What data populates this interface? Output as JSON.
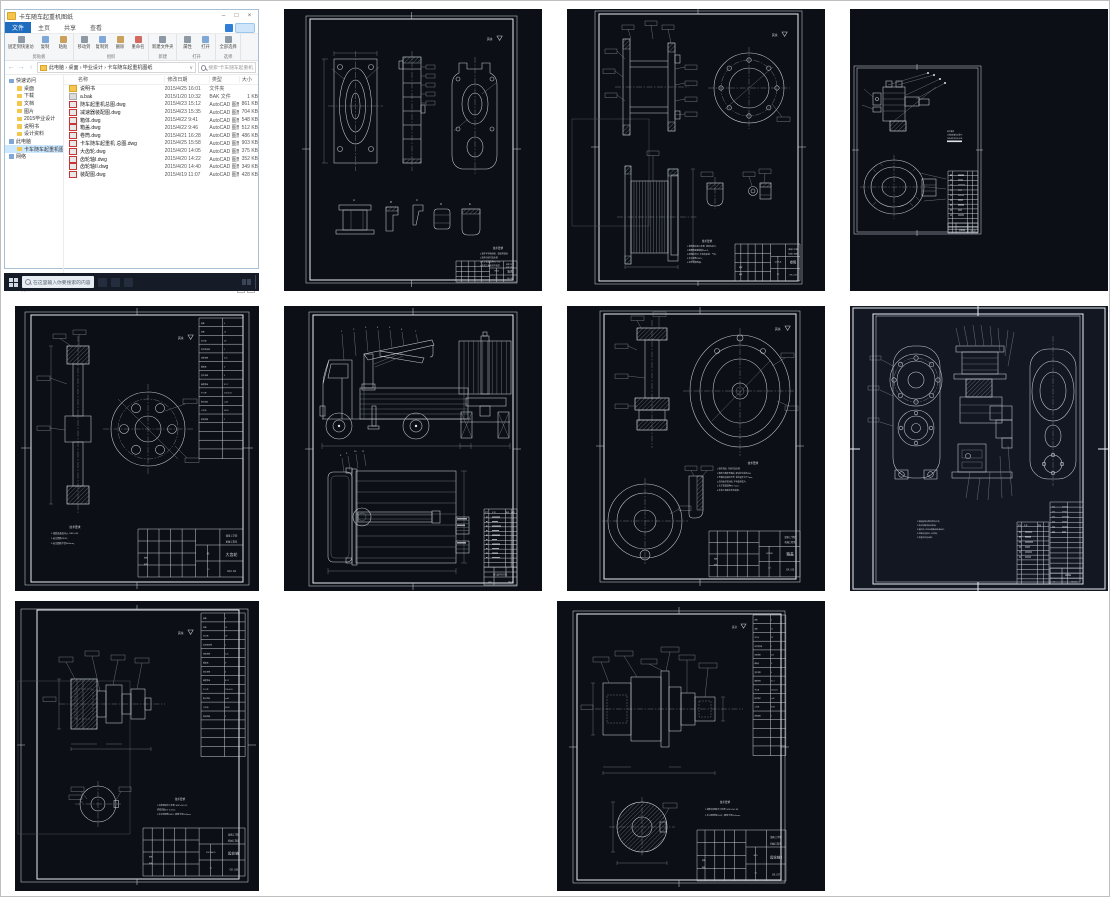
{
  "explorer": {
    "title": "卡车随车起重机图纸",
    "window_controls": {
      "minimize": "–",
      "maximize": "□",
      "close": "×"
    },
    "tabs": {
      "file": "文件",
      "home": "主页",
      "share": "共享",
      "view": "查看"
    },
    "ribbon": {
      "g1": {
        "label": "剪贴板",
        "items": [
          "固定到快速访问",
          "复制",
          "粘贴"
        ]
      },
      "g2": {
        "label": "组织",
        "items": [
          "移动到",
          "复制到",
          "删除",
          "重命名"
        ]
      },
      "g3": {
        "label": "新建",
        "items": [
          "新建文件夹"
        ]
      },
      "g4": {
        "label": "打开",
        "items": [
          "属性",
          "打开"
        ]
      },
      "g5": {
        "label": "选择",
        "items": [
          "全部选择"
        ]
      }
    },
    "nav_arrows": {
      "back": "←",
      "forward": "→",
      "up": "↑"
    },
    "address": "此电脑 › 桌面 › 毕业设计 › 卡车随车起重机图纸",
    "address_chevron": "∨",
    "search_text": "搜索\"卡车随车起重机图纸\"",
    "columns": {
      "name": "名称",
      "date": "修改日期",
      "type": "类型",
      "size": "大小"
    },
    "sidebar": [
      {
        "label": "快速访问",
        "_pad": 4
      },
      {
        "label": "桌面",
        "_pad": 12
      },
      {
        "label": "下载",
        "_pad": 12
      },
      {
        "label": "文档",
        "_pad": 12
      },
      {
        "label": "图片",
        "_pad": 12
      },
      {
        "label": "2015毕业设计",
        "_pad": 12
      },
      {
        "label": "说明书",
        "_pad": 12
      },
      {
        "label": "设计资料",
        "_pad": 12
      },
      {
        "label": "此电脑",
        "_pad": 4
      },
      {
        "label": "卡车随车起重机图纸",
        "_pad": 12,
        "_class": "sel"
      },
      {
        "label": "网络",
        "_pad": 4
      }
    ],
    "files": [
      {
        "name": "说明书",
        "date": "2015/4/25 16:01",
        "type": "文件夹",
        "size": "",
        "_class": "folder"
      },
      {
        "name": "a.bak",
        "date": "2015/1/20 10:32",
        "type": "BAK 文件",
        "size": "1 KB",
        "_class": "bak"
      },
      {
        "name": "随车起重机总图.dwg",
        "date": "2015/4/23 15:12",
        "type": "AutoCAD 图形",
        "size": "861 KB",
        "_class": "cad"
      },
      {
        "name": "减速器装配图.dwg",
        "date": "2015/4/23 15:35",
        "type": "AutoCAD 图形",
        "size": "704 KB",
        "_class": "cad"
      },
      {
        "name": "箱体.dwg",
        "date": "2015/4/22 9:41",
        "type": "AutoCAD 图形",
        "size": "548 KB",
        "_class": "cad"
      },
      {
        "name": "箱盖.dwg",
        "date": "2015/4/22 9:46",
        "type": "AutoCAD 图形",
        "size": "512 KB",
        "_class": "cad"
      },
      {
        "name": "卷筒.dwg",
        "date": "2015/4/21 16:28",
        "type": "AutoCAD 图形",
        "size": "486 KB",
        "_class": "cad"
      },
      {
        "name": "卡车随车起重机 总图.dwg",
        "date": "2015/4/25 15:58",
        "type": "AutoCAD 图形",
        "size": "903 KB",
        "_class": "cad"
      },
      {
        "name": "大齿轮.dwg",
        "date": "2015/4/20 14:05",
        "type": "AutoCAD 图形",
        "size": "375 KB",
        "_class": "cad"
      },
      {
        "name": "齿轮轴I.dwg",
        "date": "2015/4/20 14:22",
        "type": "AutoCAD 图形",
        "size": "352 KB",
        "_class": "cad"
      },
      {
        "name": "齿轮轴II.dwg",
        "date": "2015/4/20 14:40",
        "type": "AutoCAD 图形",
        "size": "349 KB",
        "_class": "cad"
      },
      {
        "name": "装配图.dwg",
        "date": "2015/4/19 11:07",
        "type": "AutoCAD 图形",
        "size": "428 KB",
        "_class": "cad"
      }
    ],
    "status": "12 个项目",
    "taskbar": {
      "search_text": "在这里输入你要搜索的内容"
    }
  },
  "tech_heading": "技术要求",
  "surface_mark": "其余",
  "title_labels": {
    "draw": "制图",
    "check": "审核"
  },
  "institution": [
    "湖南工学院",
    "机械工程系"
  ],
  "bom_headers": {
    "no": "序号",
    "name": "名 称",
    "qty": "数量",
    "note": "备注"
  },
  "param_table": {
    "labels": [
      "模数",
      "齿数",
      "压力角",
      "齿顶高系数",
      "顶隙系数",
      "螺旋角",
      "变位系数",
      "精度等级",
      "中心距",
      "配对齿轮",
      "公法线",
      "跨测齿数"
    ],
    "values": [
      "4",
      "13",
      "20°",
      "1",
      "0.25",
      "0°",
      "0",
      "8-7-7",
      "170±0.03",
      "z=40",
      "30.85",
      "2"
    ]
  },
  "sheets": [
    {
      "name": "箱体",
      "no": "GK.I.02",
      "scale": "1:2",
      "material": "HT200",
      "details": [
        "A",
        "B",
        "C",
        "D",
        "E"
      ],
      "notes": [
        "1.铸件不得有砂眼、裂纹等缺陷;",
        "2.铸件应经时效处理;",
        "3.未注铸造圆角R3~R5;",
        "4.非加工表面涂防锈漆。"
      ]
    },
    {
      "name": "卷筒",
      "no": "GK.I.03",
      "scale": "1:2",
      "material": "Q235-A",
      "notes": [
        "1.卷筒焊后退火处理, 消除内应力;",
        "2.绳槽表面粗糙度Ra6.3;",
        "3.焊缝应均匀, 不得有夹渣、气孔;",
        "4.未注倒角2X45°;",
        "5.涂防锈漆两遍。"
      ]
    },
    {
      "name": "装配图",
      "no": "GK.I.09",
      "scale": "1:5",
      "notes": [
        "技术要求",
        "1.装配前清洗各零件;",
        "2.转动应灵活无卡滞。"
      ]
    },
    {
      "name": "大齿轮",
      "no": "GK.I.04",
      "scale": "1:2",
      "material": "45",
      "notes": [
        "1.调质及表面淬火, HRC=48;",
        "2.未注倒角2X45°;",
        "3.未注圆角半径R=5mm。"
      ]
    },
    {
      "name": "随车起重机总图",
      "no": "GK.I.01",
      "scale": "1:20",
      "balloons": [
        "1",
        "2",
        "3",
        "4",
        "5",
        "6",
        "7",
        "8",
        "9",
        "10",
        "11"
      ]
    },
    {
      "name": "箱盖",
      "no": "GK.I.05",
      "scale": "1:2",
      "material": "HT200",
      "notes": [
        "1.铸件清砂, 并经时效处理;",
        "2.箱盖与箱体合箱后, 配钻定位销孔Φ8;",
        "3.合箱后边缘应平齐, 错位量不大于2mm;",
        "4.剖分面涂密封胶, 不得使用垫片;",
        "5.未注铸造圆角R3~5mm;",
        "6.非加工表面涂灰色油漆。"
      ]
    },
    {
      "name": "减速器",
      "no": "GK.I.00",
      "scale": "1:5",
      "notes": [
        "1.装配前所有零件清洗干净;",
        "2.啮合侧隙用铅丝检验;",
        "3.箱内注入N150润滑油至油标位;",
        "4.空载试运转2h, 无异响;",
        "5.表面涂灰色油漆。"
      ]
    },
    {
      "name": "齿轮轴I",
      "no": "GK.I.06",
      "scale": "1:1",
      "material": "20CrMnTi",
      "notes": [
        "1.齿部渗碳淬火处理, HRC=58~62,",
        "渗碳深度0.8~1.2mm;",
        "2.未注明倒角2X45°, 圆角半径R=2mm。"
      ]
    },
    {
      "name": "齿轮轴II",
      "no": "GK.I.07",
      "scale": "1:1",
      "material": "40Cr",
      "notes": [
        "1.调质及表面淬火处理, HRC=50~62;",
        "2.未注明倒角2X45°, 圆角半径R=2mm。"
      ]
    }
  ]
}
